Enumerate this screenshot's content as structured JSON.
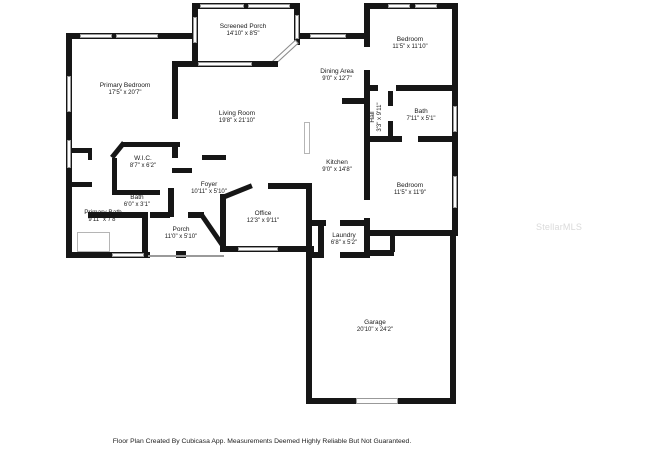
{
  "rooms": [
    {
      "name": "Screened Porch",
      "dims": "14'10\" x 8'5\""
    },
    {
      "name": "Bedroom",
      "dims": "11'5\" x 11'10\""
    },
    {
      "name": "Primary Bedroom",
      "dims": "17'5\" x 20'7\""
    },
    {
      "name": "Dining Area",
      "dims": "9'0\" x 12'7\""
    },
    {
      "name": "Living Room",
      "dims": "19'8\" x 21'10\""
    },
    {
      "name": "Bath",
      "dims": "7'11\" x 5'1\""
    },
    {
      "name": "Hall",
      "dims": "3'3\" x 9'11\""
    },
    {
      "name": "W.I.C.",
      "dims": "8'7\" x 6'2\""
    },
    {
      "name": "Kitchen",
      "dims": "9'0\" x 14'8\""
    },
    {
      "name": "Foyer",
      "dims": "10'11\" x 5'10\""
    },
    {
      "name": "Bath",
      "dims": "6'0\" x 3'1\""
    },
    {
      "name": "Bedroom",
      "dims": "11'5\" x 11'9\""
    },
    {
      "name": "Primary Bath",
      "dims": "9'11\" x 7'8\""
    },
    {
      "name": "Office",
      "dims": "12'3\" x 9'11\""
    },
    {
      "name": "Porch",
      "dims": "11'0\" x 5'10\""
    },
    {
      "name": "Laundry",
      "dims": "6'8\" x 5'2\""
    },
    {
      "name": "Garage",
      "dims": "20'10\" x 24'2\""
    }
  ],
  "footer": {
    "text": "Floor Plan Created By Cubicasa App. Measurements Deemed Highly Reliable But Not Guaranteed."
  },
  "watermark": {
    "text": "StellarMLS"
  },
  "colors": {
    "wall": "#161616",
    "window_frame": "#999999",
    "watermark": "#dadada",
    "background": "#ffffff"
  }
}
